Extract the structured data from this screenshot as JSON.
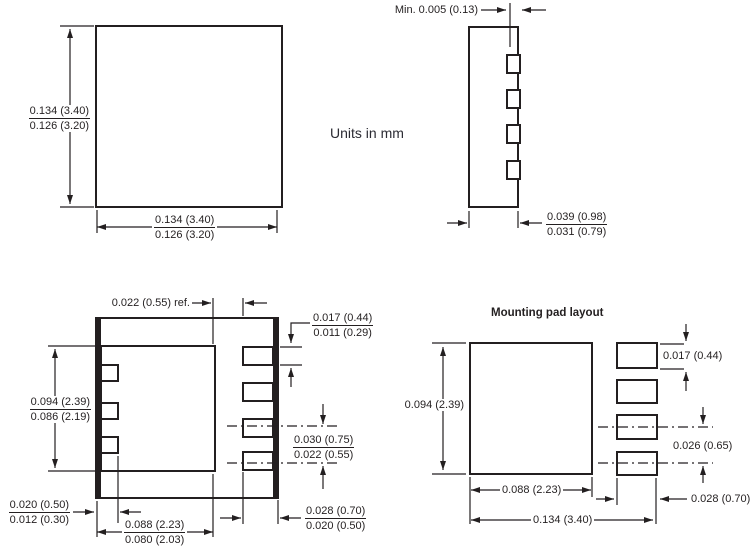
{
  "note": "Units in mm",
  "top_view": {
    "height_max": "0.134 (3.40)",
    "height_min": "0.126 (3.20)",
    "width_max": "0.134 (3.40)",
    "width_min": "0.126 (3.20)"
  },
  "side_view": {
    "lead_inset": "Min. 0.005 (0.13)",
    "width_max": "0.039 (0.98)",
    "width_min": "0.031 (0.79)"
  },
  "bottom_view": {
    "pad_edge_ref": "0.022 (0.55) ref.",
    "lead_width_max": "0.017 (0.44)",
    "lead_width_min": "0.011 (0.29)",
    "pad_height_max": "0.094 (2.39)",
    "pad_height_min": "0.086 (2.19)",
    "lead_pitch_max": "0.030 (0.75)",
    "lead_pitch_min": "0.022 (0.55)",
    "side_lead_len_max": "0.020 (0.50)",
    "side_lead_len_min": "0.012 (0.30)",
    "pad_width_max": "0.088 (2.23)",
    "pad_width_min": "0.080 (2.03)",
    "lead_len_max": "0.028 (0.70)",
    "lead_len_min": "0.020 (0.50)"
  },
  "mounting_pad": {
    "title": "Mounting pad layout",
    "pad_height": "0.094 (2.39)",
    "lead_height": "0.017 (0.44)",
    "lead_pitch": "0.026 (0.65)",
    "pad_width": "0.088 (2.23)",
    "overall_width": "0.134 (3.40)",
    "lead_width": "0.028 (0.70)"
  }
}
